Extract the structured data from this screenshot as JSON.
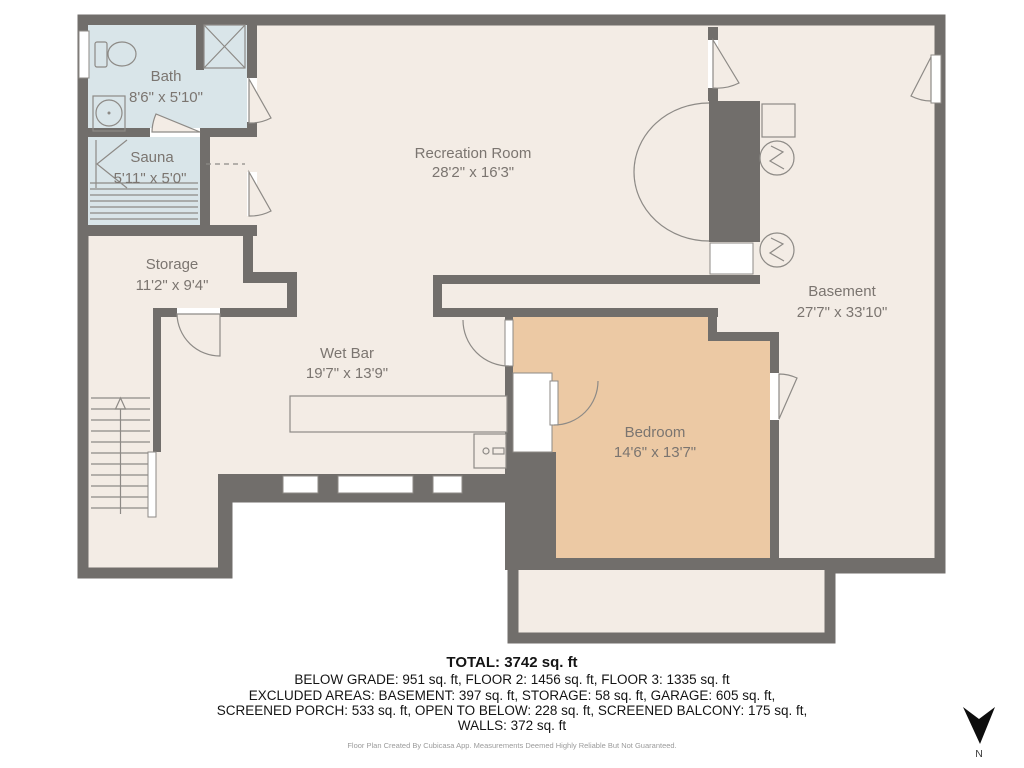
{
  "plan": {
    "rooms": [
      {
        "id": "bath",
        "name": "Bath",
        "dims": "8'6\" x 5'10\""
      },
      {
        "id": "sauna",
        "name": "Sauna",
        "dims": "5'11\" x 5'0\""
      },
      {
        "id": "storage",
        "name": "Storage",
        "dims": "11'2\" x 9'4\""
      },
      {
        "id": "recreation",
        "name": "Recreation Room",
        "dims": "28'2\" x 16'3\""
      },
      {
        "id": "wetbar",
        "name": "Wet Bar",
        "dims": "19'7\" x 13'9\""
      },
      {
        "id": "bedroom",
        "name": "Bedroom",
        "dims": "14'6\" x 13'7\""
      },
      {
        "id": "basement",
        "name": "Basement",
        "dims": "27'7\" x 33'10\""
      }
    ],
    "fixtures": [
      "toilet",
      "shower",
      "sink",
      "sauna-heater",
      "sauna-benches",
      "stairs",
      "counter",
      "bar-appliance",
      "water-heater",
      "water-heater"
    ]
  },
  "summary": {
    "total": "TOTAL: 3742 sq. ft",
    "line1": "BELOW GRADE: 951 sq. ft, FLOOR 2: 1456 sq. ft, FLOOR 3: 1335 sq. ft",
    "line2": "EXCLUDED AREAS: BASEMENT: 397 sq. ft, STORAGE: 58 sq. ft, GARAGE: 605 sq. ft,",
    "line3": "SCREENED PORCH: 533 sq. ft, OPEN TO BELOW: 228 sq. ft, SCREENED BALCONY: 175 sq. ft,",
    "line4": "WALLS: 372 sq. ft"
  },
  "credit": "Floor Plan Created By Cubicasa App. Measurements Deemed Highly Reliable But Not Guaranteed.",
  "compass": {
    "label": "N"
  },
  "colors": {
    "wall": "#716e6b",
    "floor": "#f3ece5",
    "wet_room": "#d9e5e9",
    "bedroom": "#ecc9a4",
    "outline": "#8d8a86",
    "room_label": "#7b7570",
    "footer_text": "#141414",
    "credit_text": "#9b9b9b"
  }
}
